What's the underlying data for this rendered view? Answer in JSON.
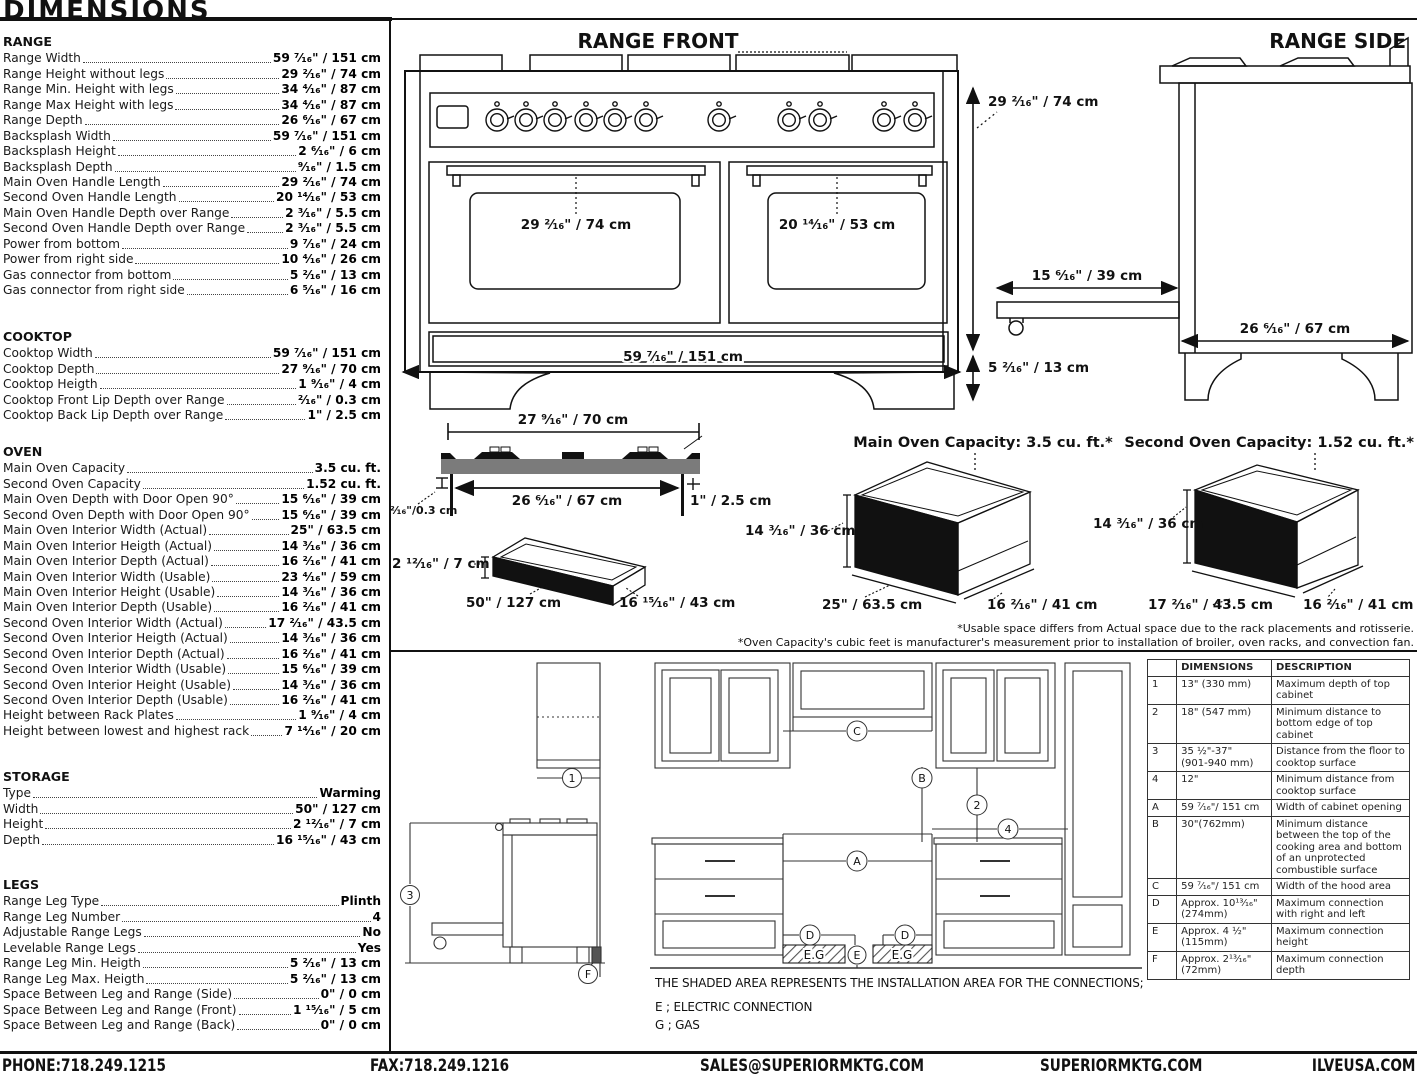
{
  "page": {
    "title": "DIMENSIONS"
  },
  "specs": {
    "sections": [
      {
        "heading": "RANGE",
        "rows": [
          [
            "Range Width",
            "59 ⁷⁄₁₆\" / 151 cm"
          ],
          [
            "Range Height without legs",
            "29 ²⁄₁₆\" / 74 cm"
          ],
          [
            "Range Min. Height with legs",
            "34 ⁴⁄₁₆\" / 87 cm"
          ],
          [
            "Range Max Height with legs",
            "34 ⁴⁄₁₆\" / 87 cm"
          ],
          [
            "Range Depth",
            "26 ⁶⁄₁₆\" / 67 cm"
          ],
          [
            "Backsplash Width",
            "59 ⁷⁄₁₆\" / 151 cm"
          ],
          [
            "Backsplash Height",
            "2 ⁶⁄₁₆\" / 6 cm"
          ],
          [
            "Backsplash Depth",
            "⁹⁄₁₆\" / 1.5 cm"
          ],
          [
            "Main Oven Handle Length",
            "29 ²⁄₁₆\" / 74 cm"
          ],
          [
            "Second Oven Handle Length",
            "20 ¹⁴⁄₁₆\" / 53 cm"
          ],
          [
            "Main Oven Handle Depth over Range",
            "2 ³⁄₁₆\" / 5.5 cm"
          ],
          [
            "Second Oven Handle Depth over Range",
            "2 ³⁄₁₆\" / 5.5 cm"
          ],
          [
            "Power from bottom",
            "9 ⁷⁄₁₆\" / 24 cm"
          ],
          [
            "Power from right side",
            "10 ⁴⁄₁₆\" / 26 cm"
          ],
          [
            "Gas connector from bottom",
            "5 ²⁄₁₆\" / 13 cm"
          ],
          [
            "Gas connector from right side",
            "6 ⁵⁄₁₆\" / 16 cm"
          ]
        ]
      },
      {
        "heading": "COOKTOP",
        "rows": [
          [
            "Cooktop Width",
            "59 ⁷⁄₁₆\" / 151 cm"
          ],
          [
            "Cooktop Depth",
            "27 ⁹⁄₁₆\" / 70 cm"
          ],
          [
            "Cooktop Heigth",
            "1 ⁹⁄₁₆\" / 4 cm"
          ],
          [
            "Cooktop Front Lip Depth over Range",
            "²⁄₁₆\" / 0.3 cm"
          ],
          [
            "Cooktop Back Lip Depth over Range",
            "1\" / 2.5 cm"
          ]
        ]
      },
      {
        "heading": "OVEN",
        "rows": [
          [
            "Main Oven Capacity",
            "3.5 cu. ft."
          ],
          [
            "Second Oven Capacity",
            "1.52 cu. ft."
          ],
          [
            "Main Oven Depth with Door Open 90°",
            "15 ⁶⁄₁₆\" / 39 cm"
          ],
          [
            "Second Oven Depth with Door Open 90°",
            "15 ⁶⁄₁₆\" / 39 cm"
          ],
          [
            "Main Oven Interior Width (Actual)",
            "25\" / 63.5 cm"
          ],
          [
            "Main Oven Interior Heigth (Actual)",
            "14 ³⁄₁₆\" / 36 cm"
          ],
          [
            "Main Oven Interior Depth (Actual)",
            "16 ²⁄₁₆\" / 41 cm"
          ],
          [
            "Main Oven Interior Width (Usable)",
            "23 ⁴⁄₁₆\" / 59 cm"
          ],
          [
            "Main Oven Interior Height (Usable)",
            "14 ³⁄₁₆\" / 36 cm"
          ],
          [
            "Main Oven Interior Depth (Usable)",
            "16 ²⁄₁₆\" / 41 cm"
          ],
          [
            "Second Oven Interior Width (Actual)",
            "17 ²⁄₁₆\" / 43.5 cm"
          ],
          [
            "Second Oven Interior Heigth (Actual)",
            "14 ³⁄₁₆\" / 36 cm"
          ],
          [
            "Second Oven Interior Depth (Actual)",
            "16 ²⁄₁₆\" / 41 cm"
          ],
          [
            "Second Oven Interior Width (Usable)",
            "15 ⁶⁄₁₆\" / 39 cm"
          ],
          [
            "Second Oven Interior Height (Usable)",
            "14 ³⁄₁₆\" / 36 cm"
          ],
          [
            "Second Oven Interior Depth (Usable)",
            "16 ²⁄₁₆\" / 41 cm"
          ],
          [
            "Height between Rack Plates",
            "1 ⁹⁄₁₆\" / 4 cm"
          ],
          [
            "Height between lowest and highest rack",
            "7 ¹⁴⁄₁₆\" / 20 cm"
          ]
        ]
      },
      {
        "heading": "STORAGE",
        "rows": [
          [
            "Type",
            "Warming"
          ],
          [
            "Width",
            "50\" / 127 cm"
          ],
          [
            "Height",
            "2 ¹²⁄₁₆\" / 7 cm"
          ],
          [
            "Depth",
            "16 ¹⁵⁄₁₆\" / 43 cm"
          ]
        ]
      },
      {
        "heading": "LEGS",
        "rows": [
          [
            "Range Leg Type",
            "Plinth"
          ],
          [
            "Range Leg Number",
            "4"
          ],
          [
            "Adjustable Range Legs",
            "No"
          ],
          [
            "Levelable Range Legs",
            "Yes"
          ],
          [
            "Range Leg Min. Heigth",
            "5 ²⁄₁₆\" / 13 cm"
          ],
          [
            "Range Leg Max. Heigth",
            "5 ²⁄₁₆\" / 13 cm"
          ],
          [
            "Space Between Leg and Range (Side)",
            "0\" / 0 cm"
          ],
          [
            "Space Between Leg and Range (Front)",
            "1 ¹⁵⁄₁₆\" / 5 cm"
          ],
          [
            "Space Between Leg and Range (Back)",
            "0\" / 0 cm"
          ]
        ]
      }
    ]
  },
  "range_front": {
    "title": "RANGE FRONT",
    "main_handle": "29 ²⁄₁₆\" / 74 cm",
    "second_handle": "20 ¹⁴⁄₁₆\" / 53 cm",
    "width": "59 ⁷⁄₁₆\" / 151 cm"
  },
  "range_side": {
    "title": "RANGE SIDE",
    "height": "29 ²⁄₁₆\" / 74 cm",
    "drawer": "15 ⁶⁄₁₆\" / 39 cm",
    "legs": "5 ²⁄₁₆\" / 13 cm",
    "depth": "26 ⁶⁄₁₆\" / 67 cm"
  },
  "cooktop": {
    "width": "27 ⁹⁄₁₆\" / 70 cm",
    "inner": "26 ⁶⁄₁₆\" / 67 cm",
    "front_lip": "²⁄₁₆\"/0.3 cm",
    "back_lip": "1\" / 2.5 cm"
  },
  "storage": {
    "height": "2 ¹²⁄₁₆\" / 7 cm",
    "width": "50\" / 127 cm",
    "depth": "16 ¹⁵⁄₁₆\" / 43 cm"
  },
  "main_oven": {
    "title": "Main Oven Capacity: 3.5 cu. ft.*",
    "height": "14 ³⁄₁₆\" / 36 cm",
    "width": "25\" / 63.5 cm",
    "depth": "16 ²⁄₁₆\" / 41 cm"
  },
  "second_oven": {
    "title": "Second Oven Capacity: 1.52 cu. ft.*",
    "height": "14 ³⁄₁₆\" / 36 cm",
    "width": "17 ²⁄₁₆\" / 43.5 cm",
    "depth": "16 ²⁄₁₆\" / 41 cm"
  },
  "footnotes": {
    "usable": "*Usable space differs from Actual space due to the rack placements and rotisserie.",
    "capacity": "*Oven Capacity's cubic feet is manufacturer's measurement prior to installation of broiler, oven racks, and convection fan."
  },
  "notes": {
    "shaded": "THE SHADED AREA REPRESENTS THE INSTALLATION AREA FOR THE CONNECTIONS;",
    "electric": "E ; ELECTRIC CONNECTION",
    "gas": "G ; GAS"
  },
  "callouts": {
    "n1": "1",
    "n2": "2",
    "n3": "3",
    "n4": "4",
    "a": "A",
    "b": "B",
    "c": "C",
    "d": "D",
    "e": "E",
    "f": "F",
    "eg": "E.G"
  },
  "install_table": {
    "headers": [
      "",
      "DIMENSIONS",
      "DESCRIPTION"
    ],
    "rows": [
      {
        "ref": "1",
        "dim": "13\" (330 mm)",
        "desc": "Maximum depth of top cabinet"
      },
      {
        "ref": "2",
        "dim": "18\" (547 mm)",
        "desc": "Minimum distance to bottom edge of top cabinet"
      },
      {
        "ref": "3",
        "dim": "35 ½\"-37\"\n(901-940 mm)",
        "desc": "Distance from the floor to cooktop surface"
      },
      {
        "ref": "4",
        "dim": "12\"",
        "desc": "Minimum distance from cooktop surface"
      },
      {
        "ref": "A",
        "dim": "59 ⁷⁄₁₆\"/ 151 cm",
        "desc": "Width of cabinet opening"
      },
      {
        "ref": "B",
        "dim": "30\"(762mm)",
        "desc": "Minimum distance between the top of the cooking area and bottom of an unprotected combustible surface"
      },
      {
        "ref": "C",
        "dim": "59 ⁷⁄₁₆\"/ 151 cm",
        "desc": "Width of the hood area"
      },
      {
        "ref": "D",
        "dim": "Approx. 10¹³⁄₁₆\"\n(274mm)",
        "desc": "Maximum connection with right and left"
      },
      {
        "ref": "E",
        "dim": "Approx. 4 ½\"\n(115mm)",
        "desc": "Maximum connection height"
      },
      {
        "ref": "F",
        "dim": "Approx. 2¹³⁄₁₆\"\n(72mm)",
        "desc": "Maximum connection depth"
      }
    ]
  },
  "footer": {
    "phone": "PHONE:718.249.1215",
    "fax": "FAX:718.249.1216",
    "email": "SALES@SUPERIORMKTG.COM",
    "site": "SUPERIORMKTG.COM",
    "brand": "ILVEUSA.COM"
  }
}
